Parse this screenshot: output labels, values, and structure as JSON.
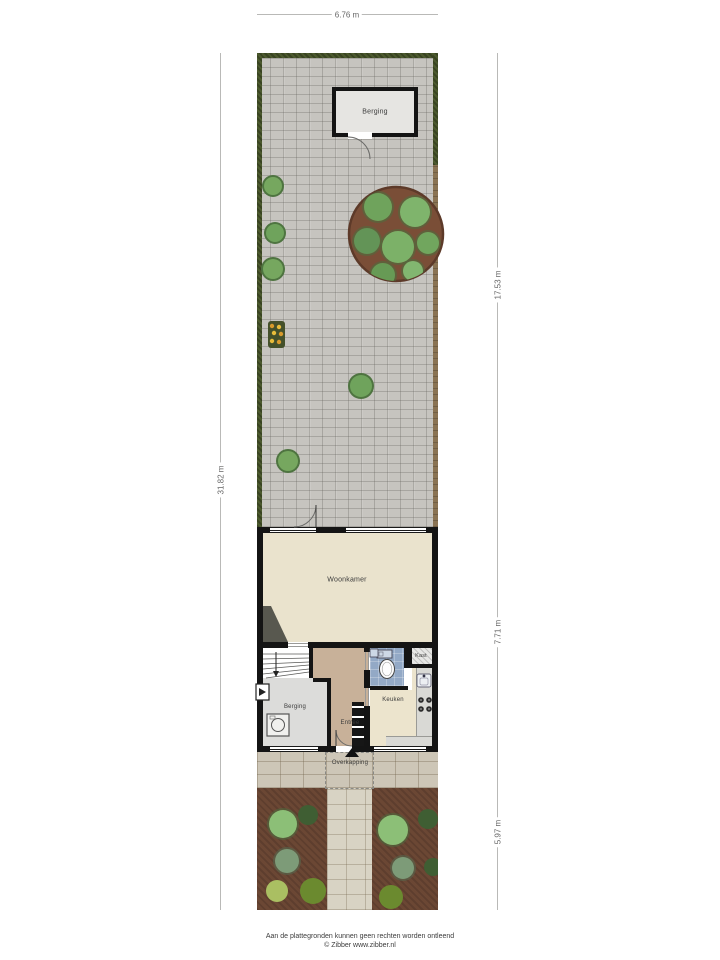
{
  "plan": {
    "rooms": {
      "shed": "Berging",
      "living_room": "Woonkamer",
      "closet": "Kast",
      "kitchen": "Keuken",
      "storage": "Berging",
      "entrance": "Entree",
      "canopy": "Overkapping"
    },
    "dimensions": {
      "total_width": "6.76 m",
      "total_height": "31.82 m",
      "back_garden_depth": "17.53 m",
      "house_depth": "7.71 m",
      "front_garden_depth": "5.97 m"
    },
    "footer": {
      "line1": "Aan de plattegronden kunnen geen rechten worden ontleend",
      "line2": "© Zibber www.zibber.nl"
    },
    "colors": {
      "wall": "#141414",
      "living_floor": "#eae3cd",
      "hall_floor": "#c8b199",
      "storage_floor": "#dcdcda",
      "toilet_floor": "#93a9c6",
      "back_paving": "#c6c4bf",
      "front_paving": "#cdc6b7",
      "hedge_green": "#4c5a2e",
      "fence_brown": "#8a7353",
      "planting_bed": "#6b4734"
    }
  }
}
